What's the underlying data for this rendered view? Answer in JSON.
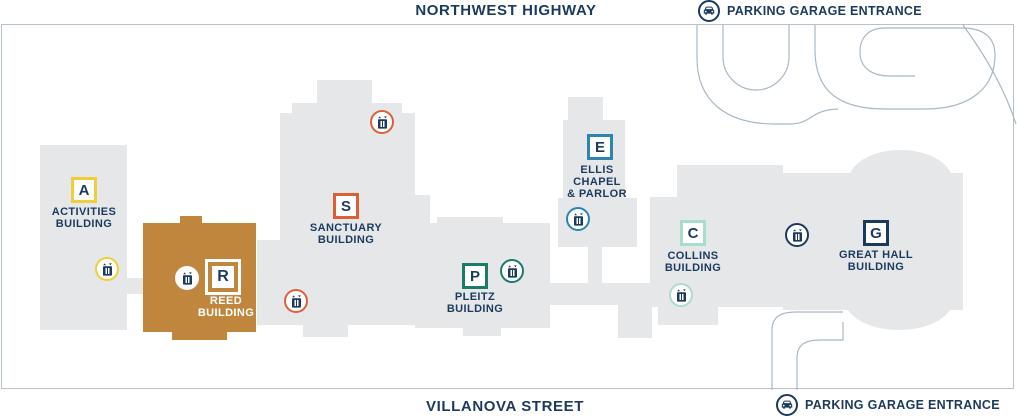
{
  "map": {
    "streets": {
      "top": "NORTHWEST HIGHWAY",
      "bottom": "VILLANOVA STREET"
    },
    "parking_entrances": [
      {
        "label": "PARKING GARAGE ENTRANCE",
        "position": "top-right"
      },
      {
        "label": "PARKING GARAGE ENTRANCE",
        "position": "bottom-right"
      }
    ]
  },
  "buildings": [
    {
      "letter": "A",
      "name": "ACTIVITIES BUILDING",
      "lines": [
        "ACTIVITIES",
        "BUILDING"
      ],
      "accent": "#EFCE3B",
      "fill": "#E5E7E9"
    },
    {
      "letter": "R",
      "name": "REED BUILDING",
      "lines": [
        "REED",
        "BUILDING"
      ],
      "accent": "#C0863E",
      "fill": "#C0863E"
    },
    {
      "letter": "S",
      "name": "SANCTUARY BUILDING",
      "lines": [
        "SANCTUARY",
        "BUILDING"
      ],
      "accent": "#DD5F38",
      "fill": "#E5E7E9"
    },
    {
      "letter": "P",
      "name": "PLEITZ BUILDING",
      "lines": [
        "PLEITZ",
        "BUILDING"
      ],
      "accent": "#1B7A68",
      "fill": "#E5E7E9"
    },
    {
      "letter": "E",
      "name": "ELLIS CHAPEL & PARLOR",
      "lines": [
        "ELLIS",
        "CHAPEL",
        "& PARLOR"
      ],
      "accent": "#2F83B3",
      "fill": "#E5E7E9"
    },
    {
      "letter": "C",
      "name": "COLLINS BUILDING",
      "lines": [
        "COLLINS",
        "BUILDING"
      ],
      "accent": "#A8DCCB",
      "fill": "#E5E7E9"
    },
    {
      "letter": "G",
      "name": "GREAT HALL BUILDING",
      "lines": [
        "GREAT HALL",
        "BUILDING"
      ],
      "accent": "#1C3A5E",
      "fill": "#E5E7E9"
    }
  ],
  "elevators": [
    {
      "at": "activities-building",
      "accent": "#EFCE3B"
    },
    {
      "at": "reed-building",
      "accent": "#FFFFFF"
    },
    {
      "at": "sanctuary-building-north",
      "accent": "#DD5F38"
    },
    {
      "at": "sanctuary-building-south",
      "accent": "#DD5F38"
    },
    {
      "at": "pleitz-building",
      "accent": "#1B7A68"
    },
    {
      "at": "ellis-chapel",
      "accent": "#2F83B3"
    },
    {
      "at": "collins-building",
      "accent": "#A8DCCB"
    },
    {
      "at": "great-hall-building",
      "accent": "#1C3A5E"
    }
  ],
  "icons": {
    "elevator": "elevator-icon",
    "parking_car": "car-icon"
  },
  "colors": {
    "navy": "#1C3A5E",
    "building_gray": "#E5E7E9",
    "reed_orange": "#C0863E",
    "badge_yellow": "#EFCE3B",
    "badge_orange": "#DD5F38",
    "badge_teal": "#1B7A68",
    "badge_blue": "#2F83B3",
    "badge_mint": "#A8DCCB",
    "road_line": "#A9B8C4",
    "frame_line": "#B5C2CC"
  }
}
